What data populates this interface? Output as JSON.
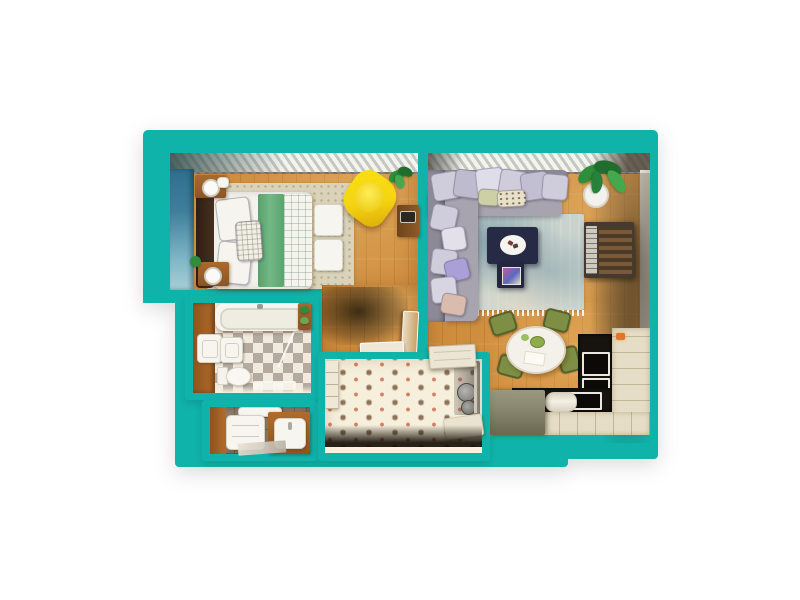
{
  "scene": {
    "type": "3d-apartment-floor-plan-render",
    "rooms": [
      {
        "name": "bedroom",
        "furniture": [
          "double-bed",
          "green-blanket",
          "headboard",
          "two-nightstands-with-lamps",
          "two-white-poufs",
          "beige-rug",
          "yellow-armchair",
          "wall-desk",
          "plant",
          "blue-curtain",
          "radiator"
        ]
      },
      {
        "name": "living-room",
        "furniture": [
          "l-shaped-gray-sofa",
          "throw-pillows",
          "distressed-blue-rug",
          "navy-coffee-table",
          "navy-side-table",
          "tv-unit",
          "potted-plant",
          "radiator"
        ]
      },
      {
        "name": "dining-kitchen",
        "furniture": [
          "round-white-table",
          "four-olive-chairs",
          "black-counter-l",
          "cream-cabinets",
          "gray-island",
          "cooktop"
        ]
      },
      {
        "name": "bathroom",
        "furniture": [
          "bathtub",
          "sink-vanity",
          "toilet",
          "bath-mat",
          "diamond-tile-floor",
          "wood-shelf"
        ]
      },
      {
        "name": "wc-laundry",
        "furniture": [
          "washing-machine",
          "wood-cabinet-sink",
          "glossy-tile-floor"
        ]
      },
      {
        "name": "hallway",
        "furniture": [
          "patterned-tile-floor",
          "wall-shelf",
          "coat-rack-with-pans",
          "bench",
          "entry-door-shadow"
        ]
      },
      {
        "name": "corridor",
        "furniture": [
          "open-door-panels",
          "floor-shadow"
        ]
      }
    ]
  },
  "palette": {
    "wall_teal": "#10b3aa",
    "floor_wood": "#cf8d3e",
    "radiator_white": "#f3f3f0",
    "radiator_gray": "#c7c7c0",
    "curtain_blue": "#2e6f8e",
    "bed_white": "#f4f2ec",
    "bed_green": "#72b885",
    "headboard_brown": "#46301f",
    "rug_bedroom": "#dad3ba",
    "armchair_yellow": "#f5d511",
    "sofa_gray": "#8d8a97",
    "sofa_seat": "#a7a4b0",
    "pillow_light": "#cfccdb",
    "pillow_lavender": "#ab9fd8",
    "pillow_sage": "#ccd0a4",
    "pillow_blush": "#d9bcae",
    "rug_living_base": "#c9d3cd",
    "rug_living_blue": "#7f9faa",
    "rug_living_sand": "#e2dbca",
    "coffee_table_navy": "#272a45",
    "tv_dark": "#453a30",
    "plant_green": "#2f8e3c",
    "dining_table_white": "#f4f1ea",
    "chair_olive": "#7e8f45",
    "kitchen_black": "#17130f",
    "cabinet_cream": "#e6ddc6",
    "island_gray": "#8b8872",
    "tile_hall": "#f6efdc",
    "motif_brown": "#8b7258",
    "motif_red": "#d77f63",
    "tile_bath_base": "#f0eadf",
    "tile_bath_diamond": "#b5aaa0",
    "bath_wood": "#b06c2c",
    "wc_floor": "#93806f",
    "white_fixture": "#f7f5ef",
    "door_wood": "#c9a268"
  }
}
